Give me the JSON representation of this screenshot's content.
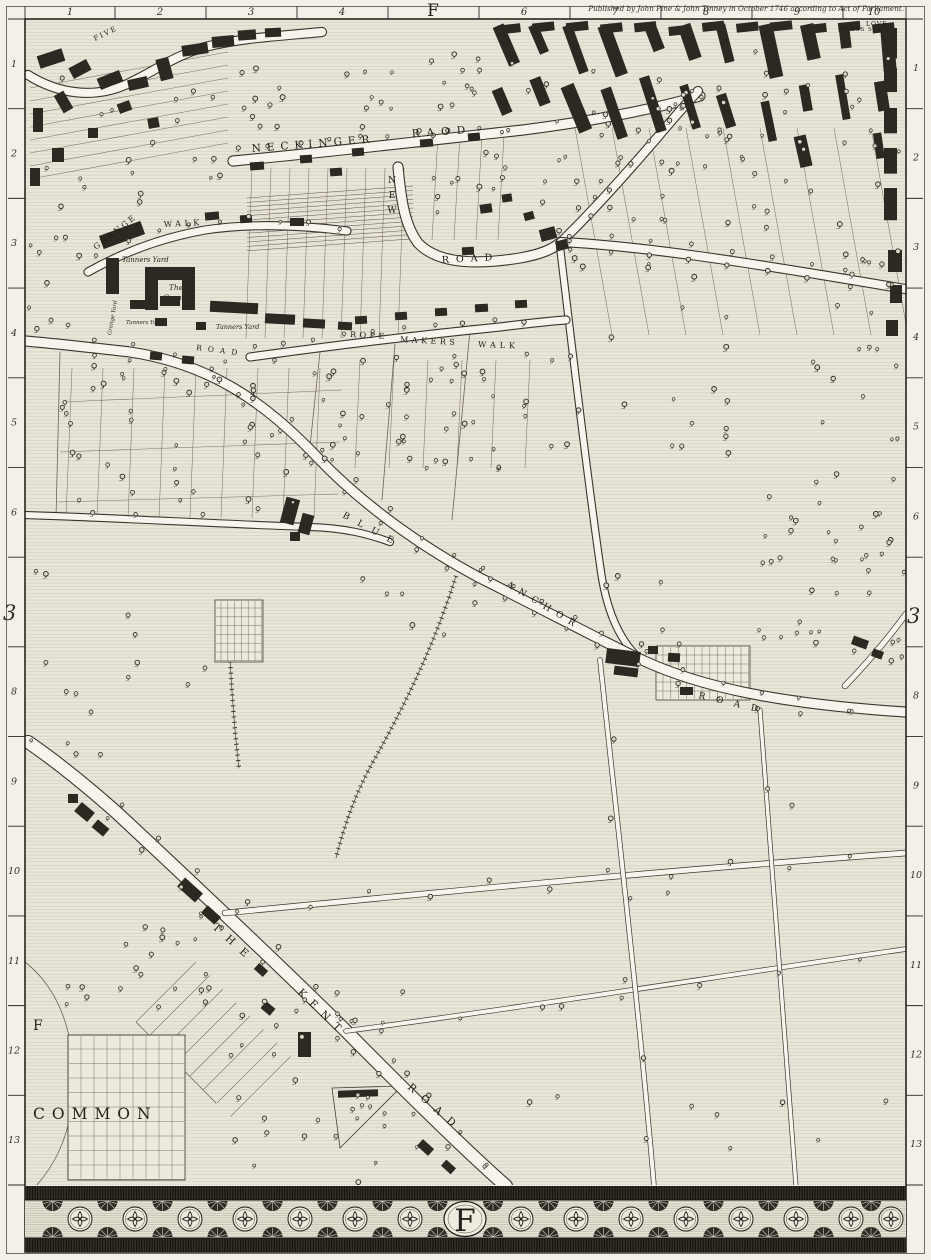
{
  "publication": "Published by John Pine & John Tinney in October 1746 according to Act of Parliament.",
  "sheet": {
    "top_letter": "F",
    "corner_letter": "F",
    "left_section": "3",
    "right_section": "3"
  },
  "rulers": {
    "top": [
      "1",
      "2",
      "3",
      "4",
      "F",
      "6",
      "7",
      "8",
      "9",
      "10"
    ],
    "side": [
      "1",
      "2",
      "3",
      "4",
      "5",
      "6",
      "3",
      "8",
      "9",
      "10",
      "11",
      "12",
      "13"
    ]
  },
  "roads": {
    "neckinger": {
      "w1": "NECKINGER",
      "w2": "RAOD"
    },
    "new_road": {
      "w1": "NEW",
      "w2": "ROAD"
    },
    "rope_makers_walk": {
      "w1": "ROPE",
      "w2": "MAKERS",
      "w3": "WALK"
    },
    "grange_walk": {
      "w1": "GRANGE",
      "w2": "WALK"
    },
    "grange_road": {
      "w1": "ROAD"
    },
    "blue_anchor_road": {
      "w1": "BLUE",
      "w2": "ANCHOR",
      "w3": "ROAD"
    },
    "kent_road": {
      "w1": "THE",
      "w2": "KENT",
      "w3": "ROAD"
    },
    "five_lane": {
      "w1": "FIVE"
    },
    "cross_street": {
      "w1": "CROSS STR."
    },
    "love_lane": {
      "w1": "LOVE"
    }
  },
  "places": {
    "tanners_yard_a": "Tanners Yard",
    "tanners_yard_b": "Tanners Yard",
    "tanners_yard_c": "Tanners Yard",
    "the_grange": {
      "line1": "The",
      "line2": "Grange"
    },
    "grange_yard": "Grange Yard",
    "common": "COMMON"
  },
  "border": {
    "center_letter": "F"
  },
  "colors": {
    "paper": "#f3f0e7",
    "field": "#e9e5d8",
    "road_fill": "#f6f4ec",
    "ink": "#24211b",
    "building": "#2c2822",
    "border_band": "#343028"
  }
}
